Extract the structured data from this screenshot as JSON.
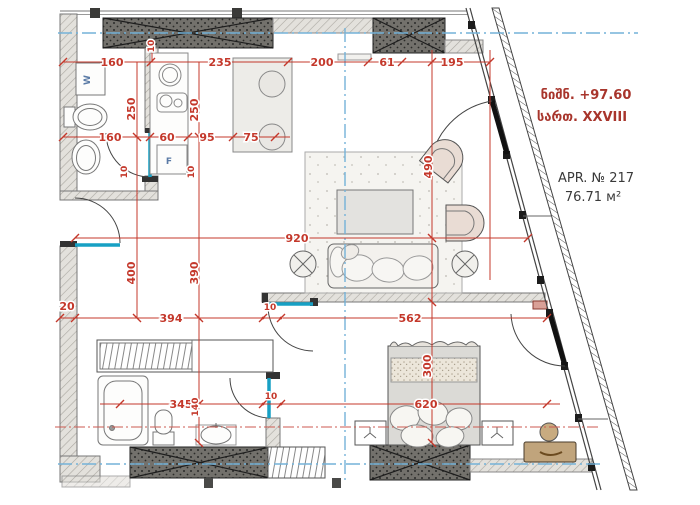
{
  "title_block": {
    "elevation": "ნიშნ. +97.60",
    "floor": "სართ. XXVIII",
    "apartment": "APR. № 217",
    "area": "76.71 м²"
  },
  "labels": {
    "washer": "W",
    "fridge": "F"
  },
  "colors": {
    "dimension_red": "#c4382b",
    "annotation_red": "#a8352c",
    "axis_blue": "#74b2d8",
    "door_teal": "#17a0c4",
    "wall_dark": "#716f6a",
    "wall_light_hatch": "#e2e0da",
    "furniture_beige": "#e9dcd3",
    "ottoman_brown": "#c0a47c"
  },
  "dims": [
    "160",
    "10",
    "235",
    "200",
    "61",
    "195",
    "250",
    "250",
    "160",
    "60",
    "95",
    "75",
    "10",
    "10",
    "490",
    "920",
    "400",
    "390",
    "20",
    "394",
    "10",
    "562",
    "300",
    "345",
    "140",
    "10",
    "620"
  ]
}
